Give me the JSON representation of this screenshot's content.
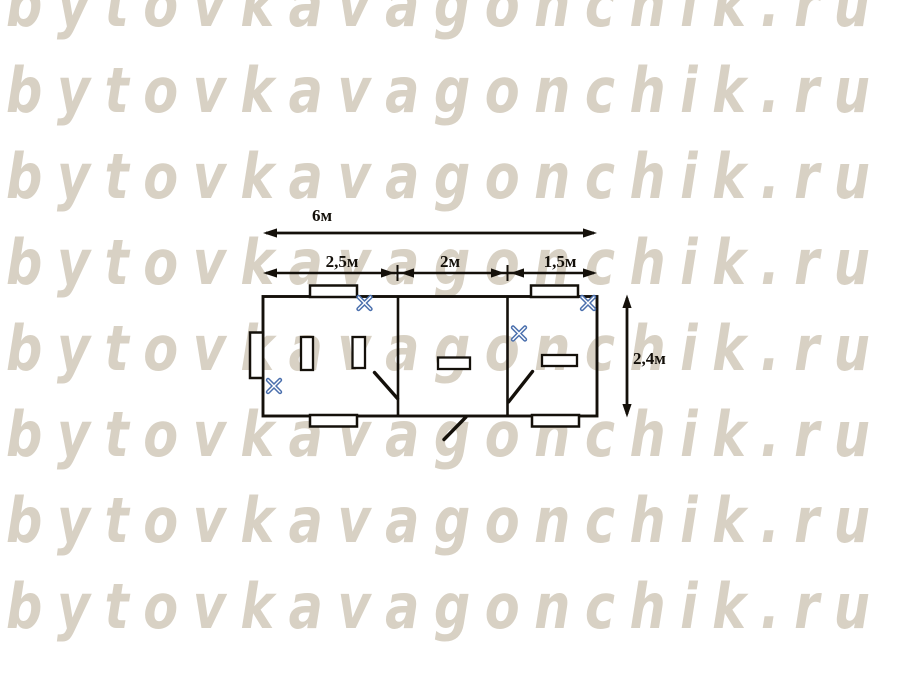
{
  "watermark": {
    "text": "bytovkavagonchik.ru",
    "color": "#d8d1c4"
  },
  "plan": {
    "total_width_label": "6м",
    "segment_labels": [
      "2,5м",
      "2м",
      "1,5м"
    ],
    "height_label": "2,4м",
    "wall_color": "#161310",
    "vent_marker_color": "#4a6fad",
    "vent_marker_icon": "x-cross-vent-icon",
    "room_count": 3
  }
}
